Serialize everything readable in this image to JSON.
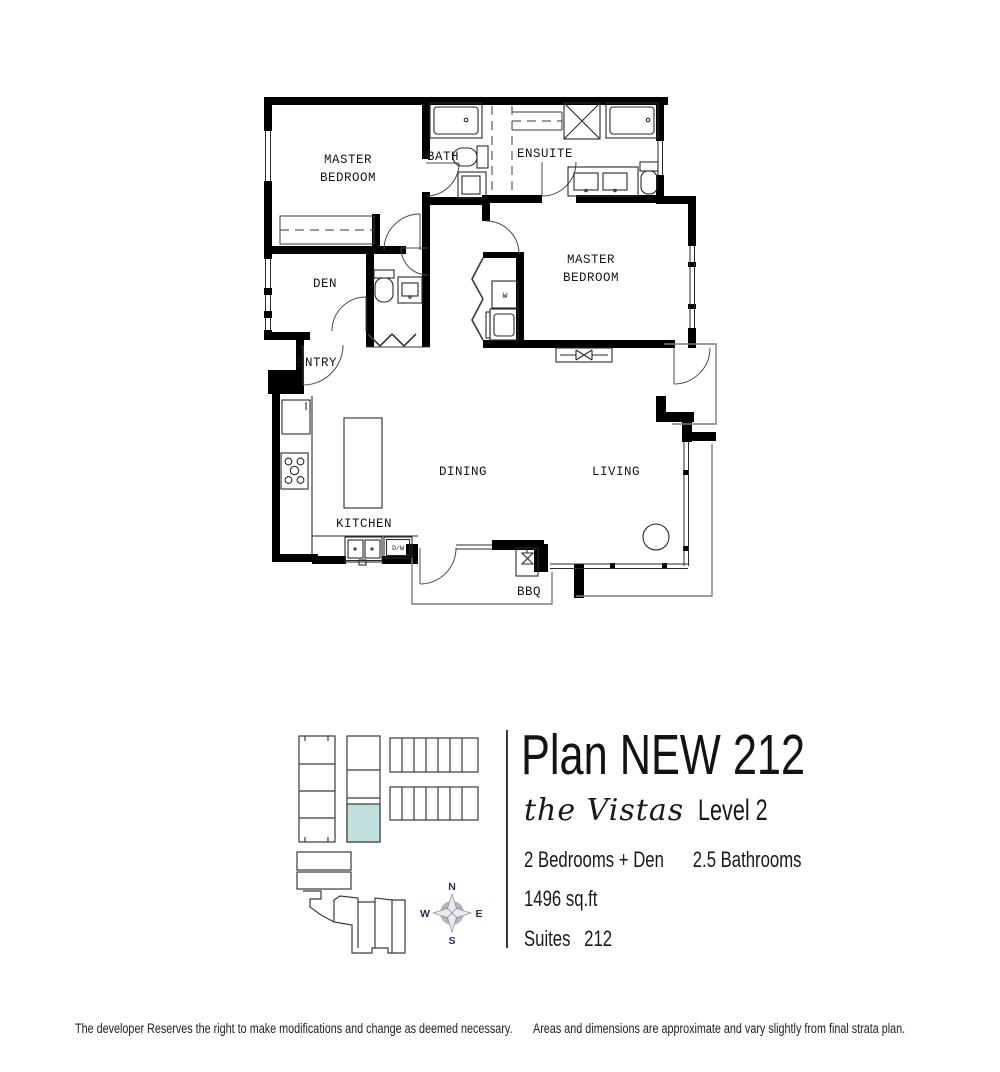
{
  "plan_info": {
    "title": "Plan NEW 212",
    "project_name": "the Vistas",
    "level": "Level 2",
    "bedrooms": "2 Bedrooms + Den",
    "bathrooms": "2.5 Bathrooms",
    "area": "1496 sq.ft",
    "suites_label": "Suites",
    "suite_number": "212"
  },
  "floorplan": {
    "labels": {
      "master_line1": "MASTER",
      "master_line2": "BEDROOM",
      "bath": "BATH",
      "ensuite": "ENSUITE",
      "den": "DEN",
      "entry": "ENTRY",
      "kitchen": "KITCHEN",
      "dining": "DINING",
      "living": "LIVING",
      "bbq": "BBQ",
      "washer": "W",
      "dishwasher": "D/W"
    }
  },
  "keyplan": {
    "highlight_color": "#bfe0dd",
    "compass": {
      "north": "N",
      "east": "E",
      "south": "S",
      "west": "W"
    }
  },
  "footer": {
    "disclaimer_left": "The developer Reserves the right to make modifications and change as deemed necessary.",
    "disclaimer_right": "Areas and dimensions are approximate and vary slightly from final strata plan."
  },
  "colors": {
    "wall": "#000000",
    "compass_navy": "#1f2c55"
  }
}
